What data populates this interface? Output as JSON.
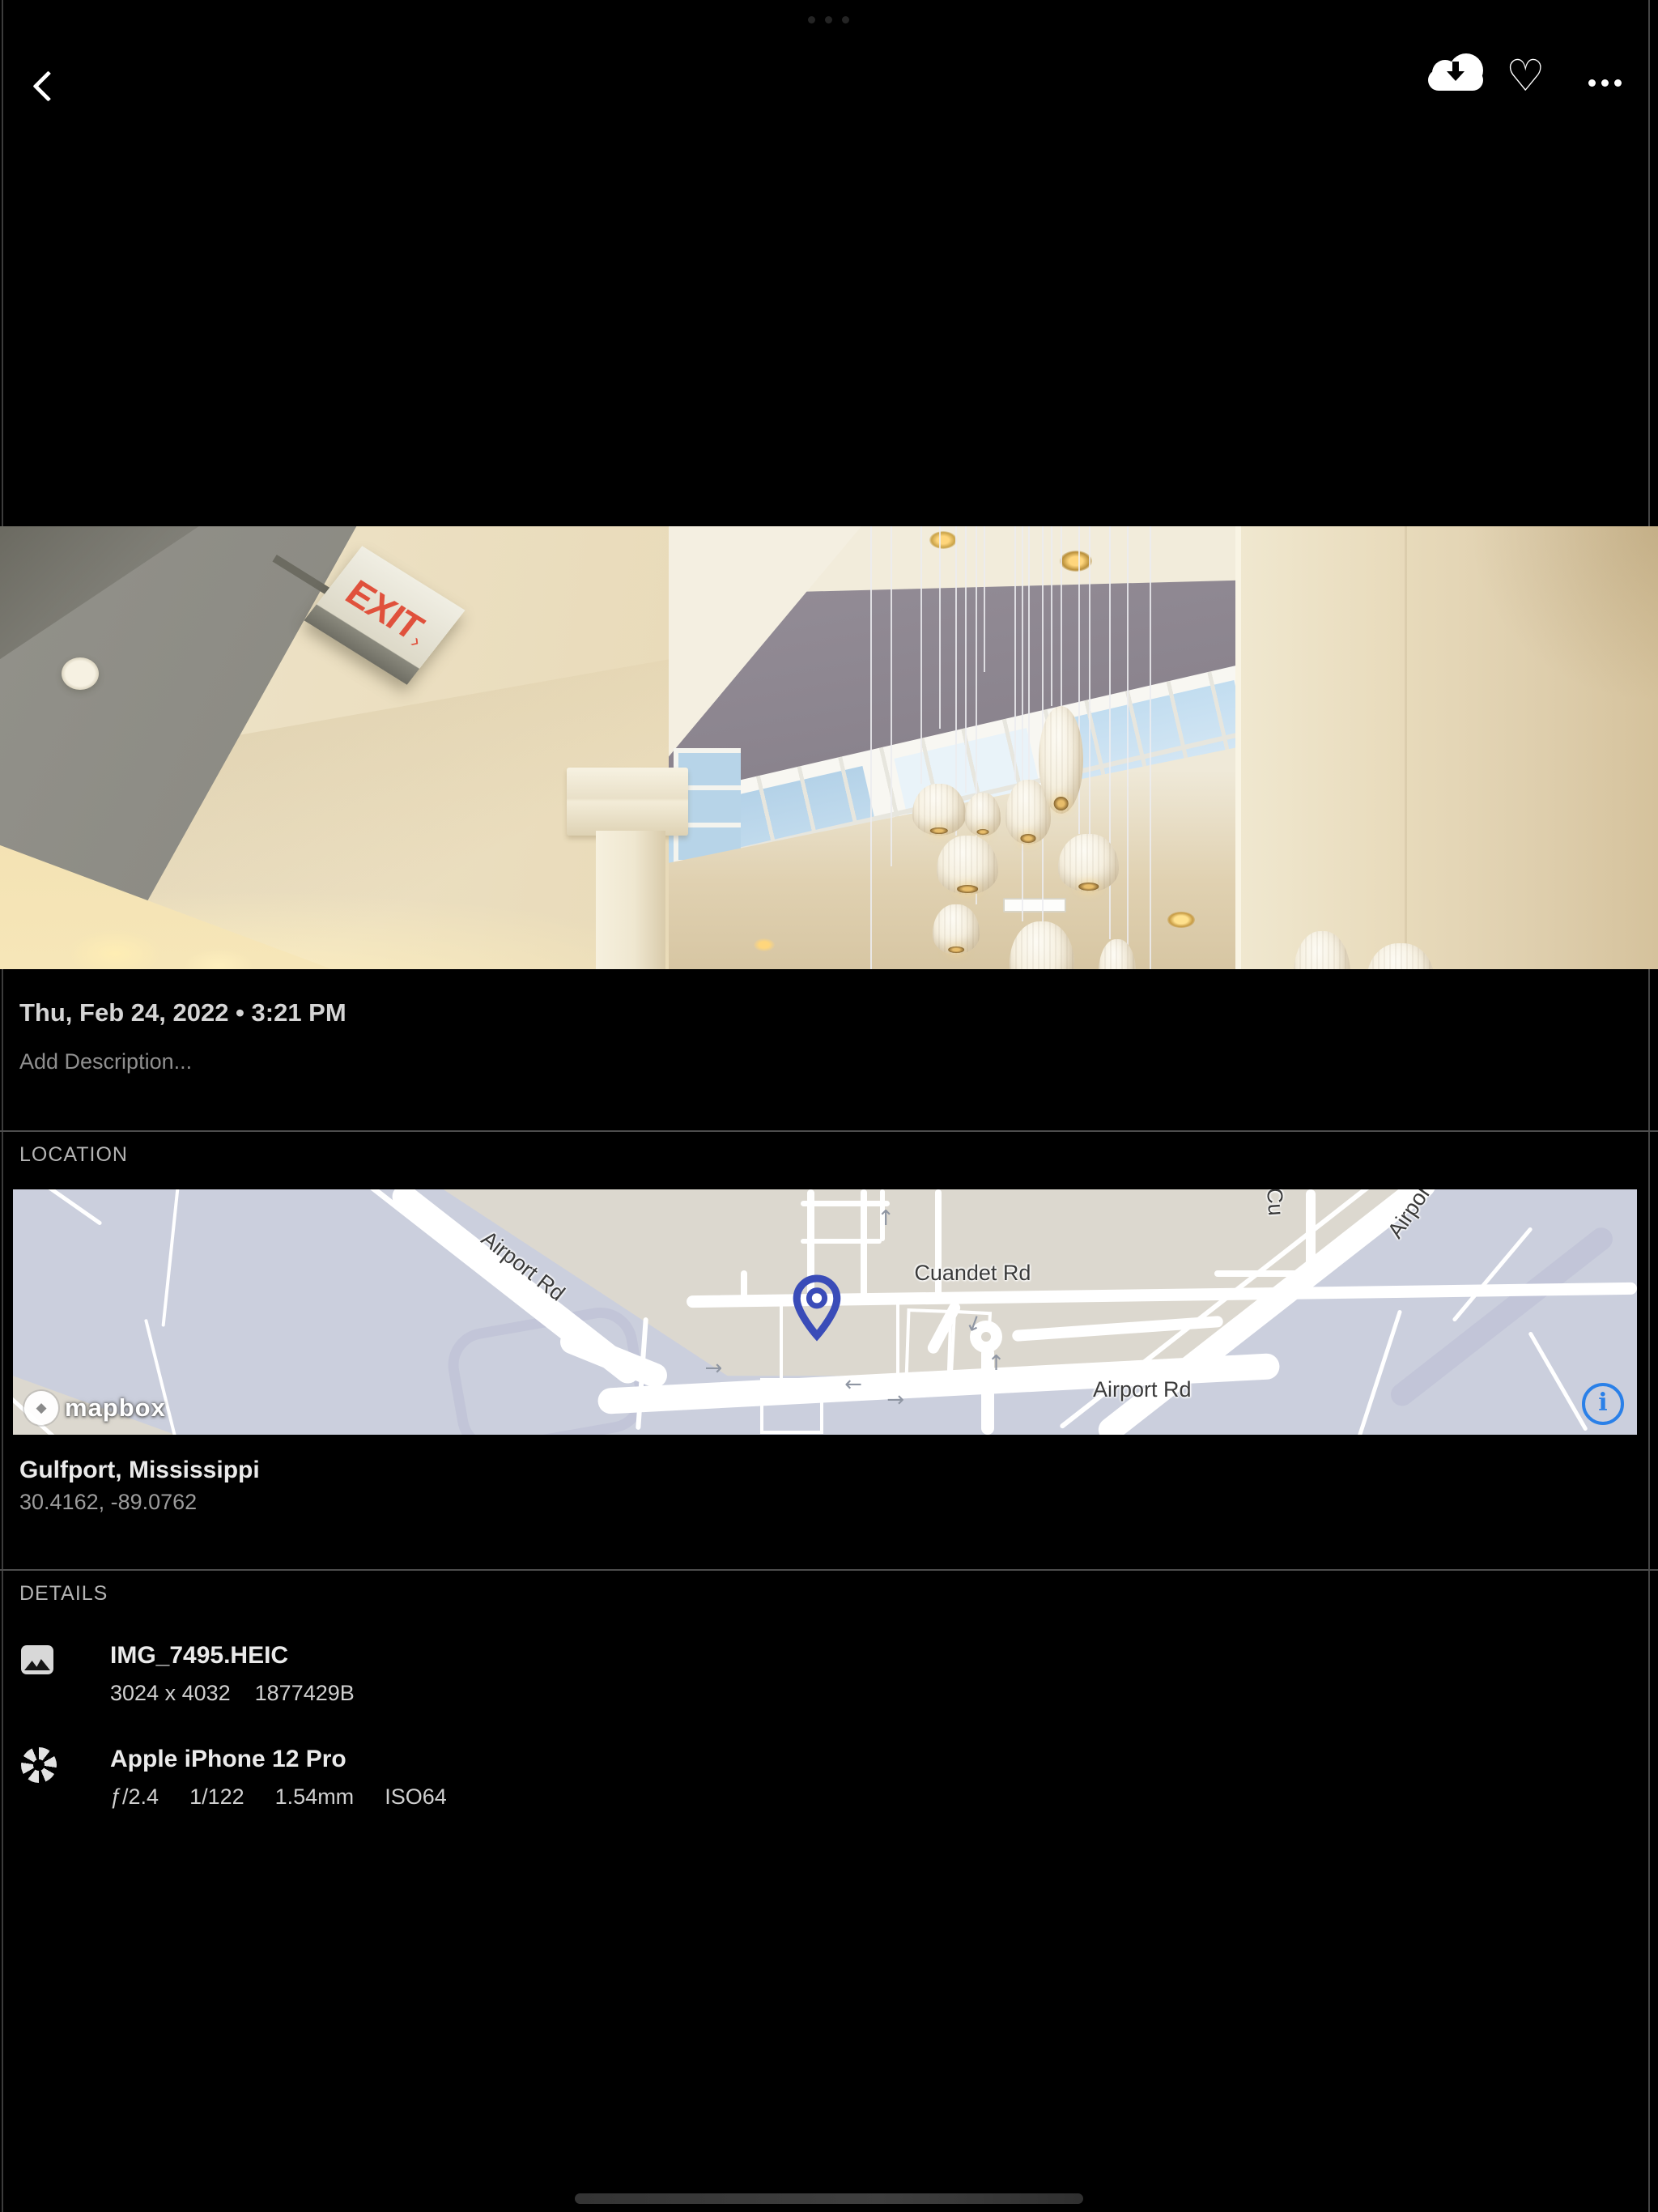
{
  "topbar": {
    "back": "back",
    "icons": {
      "heart": "♡"
    }
  },
  "system": {
    "multitask_dots": "•••"
  },
  "photo": {
    "exit_sign_text": "EXIT",
    "exit_sign_arrow": "›"
  },
  "info": {
    "date": "Thu, Feb 24, 2022 • 3:21 PM",
    "description_placeholder": "Add Description..."
  },
  "location": {
    "section_label": "LOCATION",
    "place": "Gulfport, Mississippi",
    "coordinates": "30.4162, -89.0762",
    "map": {
      "labels": {
        "upper": "Airport Rd",
        "cuandet": "Cuandet Rd",
        "lower": "Airport Rd",
        "diagonal": "Airport Rd",
        "vertical": "Cu"
      },
      "arrows": [
        "→",
        "←",
        "→",
        "↑",
        "↑",
        "↓"
      ],
      "attribution": "mapbox",
      "logo_mark": "◆",
      "info_icon": "i"
    }
  },
  "details": {
    "section_label": "DETAILS",
    "items": [
      {
        "icon": "image-icon",
        "title": "IMG_7495.HEIC",
        "meta": [
          "3024 x 4032",
          "1877429B"
        ]
      },
      {
        "icon": "aperture-icon",
        "title": "Apple iPhone 12 Pro",
        "meta": [
          "ƒ/2.4",
          "1/122",
          "1.54mm",
          "ISO64"
        ]
      }
    ]
  },
  "colors": {
    "background": "#000000",
    "accent_blue": "#2a80e8",
    "pin_indigo": "#3a4cb8",
    "map_land": "#dcd8cf",
    "map_water": "#cbcfdd",
    "map_road": "#ffffff"
  }
}
